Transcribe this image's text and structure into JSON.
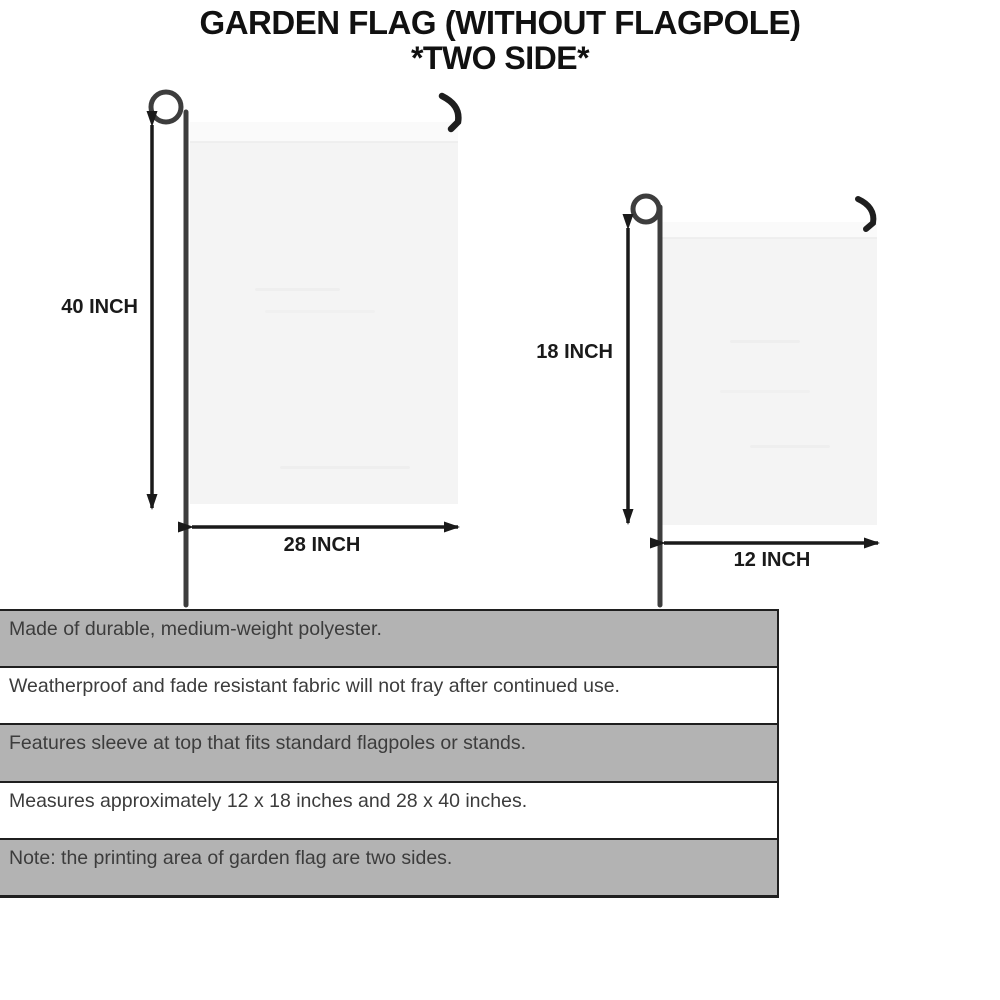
{
  "title": {
    "line1": "GARDEN FLAG (WITHOUT FLAGPOLE)",
    "line2": "*TWO SIDE*"
  },
  "diagram": {
    "large_flag": {
      "height_label": "40 INCH",
      "width_label": "28 INCH"
    },
    "small_flag": {
      "height_label": "18 INCH",
      "width_label": "12 INCH"
    }
  },
  "specs": {
    "rows": [
      {
        "text": "Made of durable, medium-weight polyester.",
        "shaded": true
      },
      {
        "text": "Weatherproof and fade resistant fabric will not fray after continued use.",
        "shaded": false
      },
      {
        "text": "Features sleeve at top that fits standard flagpoles or stands.",
        "shaded": true
      },
      {
        "text": "Measures approximately 12 x 18 inches and 28 x 40 inches.",
        "shaded": false
      },
      {
        "text": "Note: the printing area of garden flag are two sides.",
        "shaded": true
      }
    ]
  },
  "colors": {
    "title_text": "#111111",
    "dimension_text": "#1a1a1a",
    "arrow": "#1a1a1a",
    "pole": "#3d3d3d",
    "hook": "#1e1e1e",
    "flag_fill": "#f4f4f4",
    "flag_sleeve": "#fafafa",
    "row_shaded_bg": "#b3b3b3",
    "row_plain_bg": "#ffffff",
    "row_border": "#1f1f1f",
    "spec_text": "#3c3c3c"
  }
}
